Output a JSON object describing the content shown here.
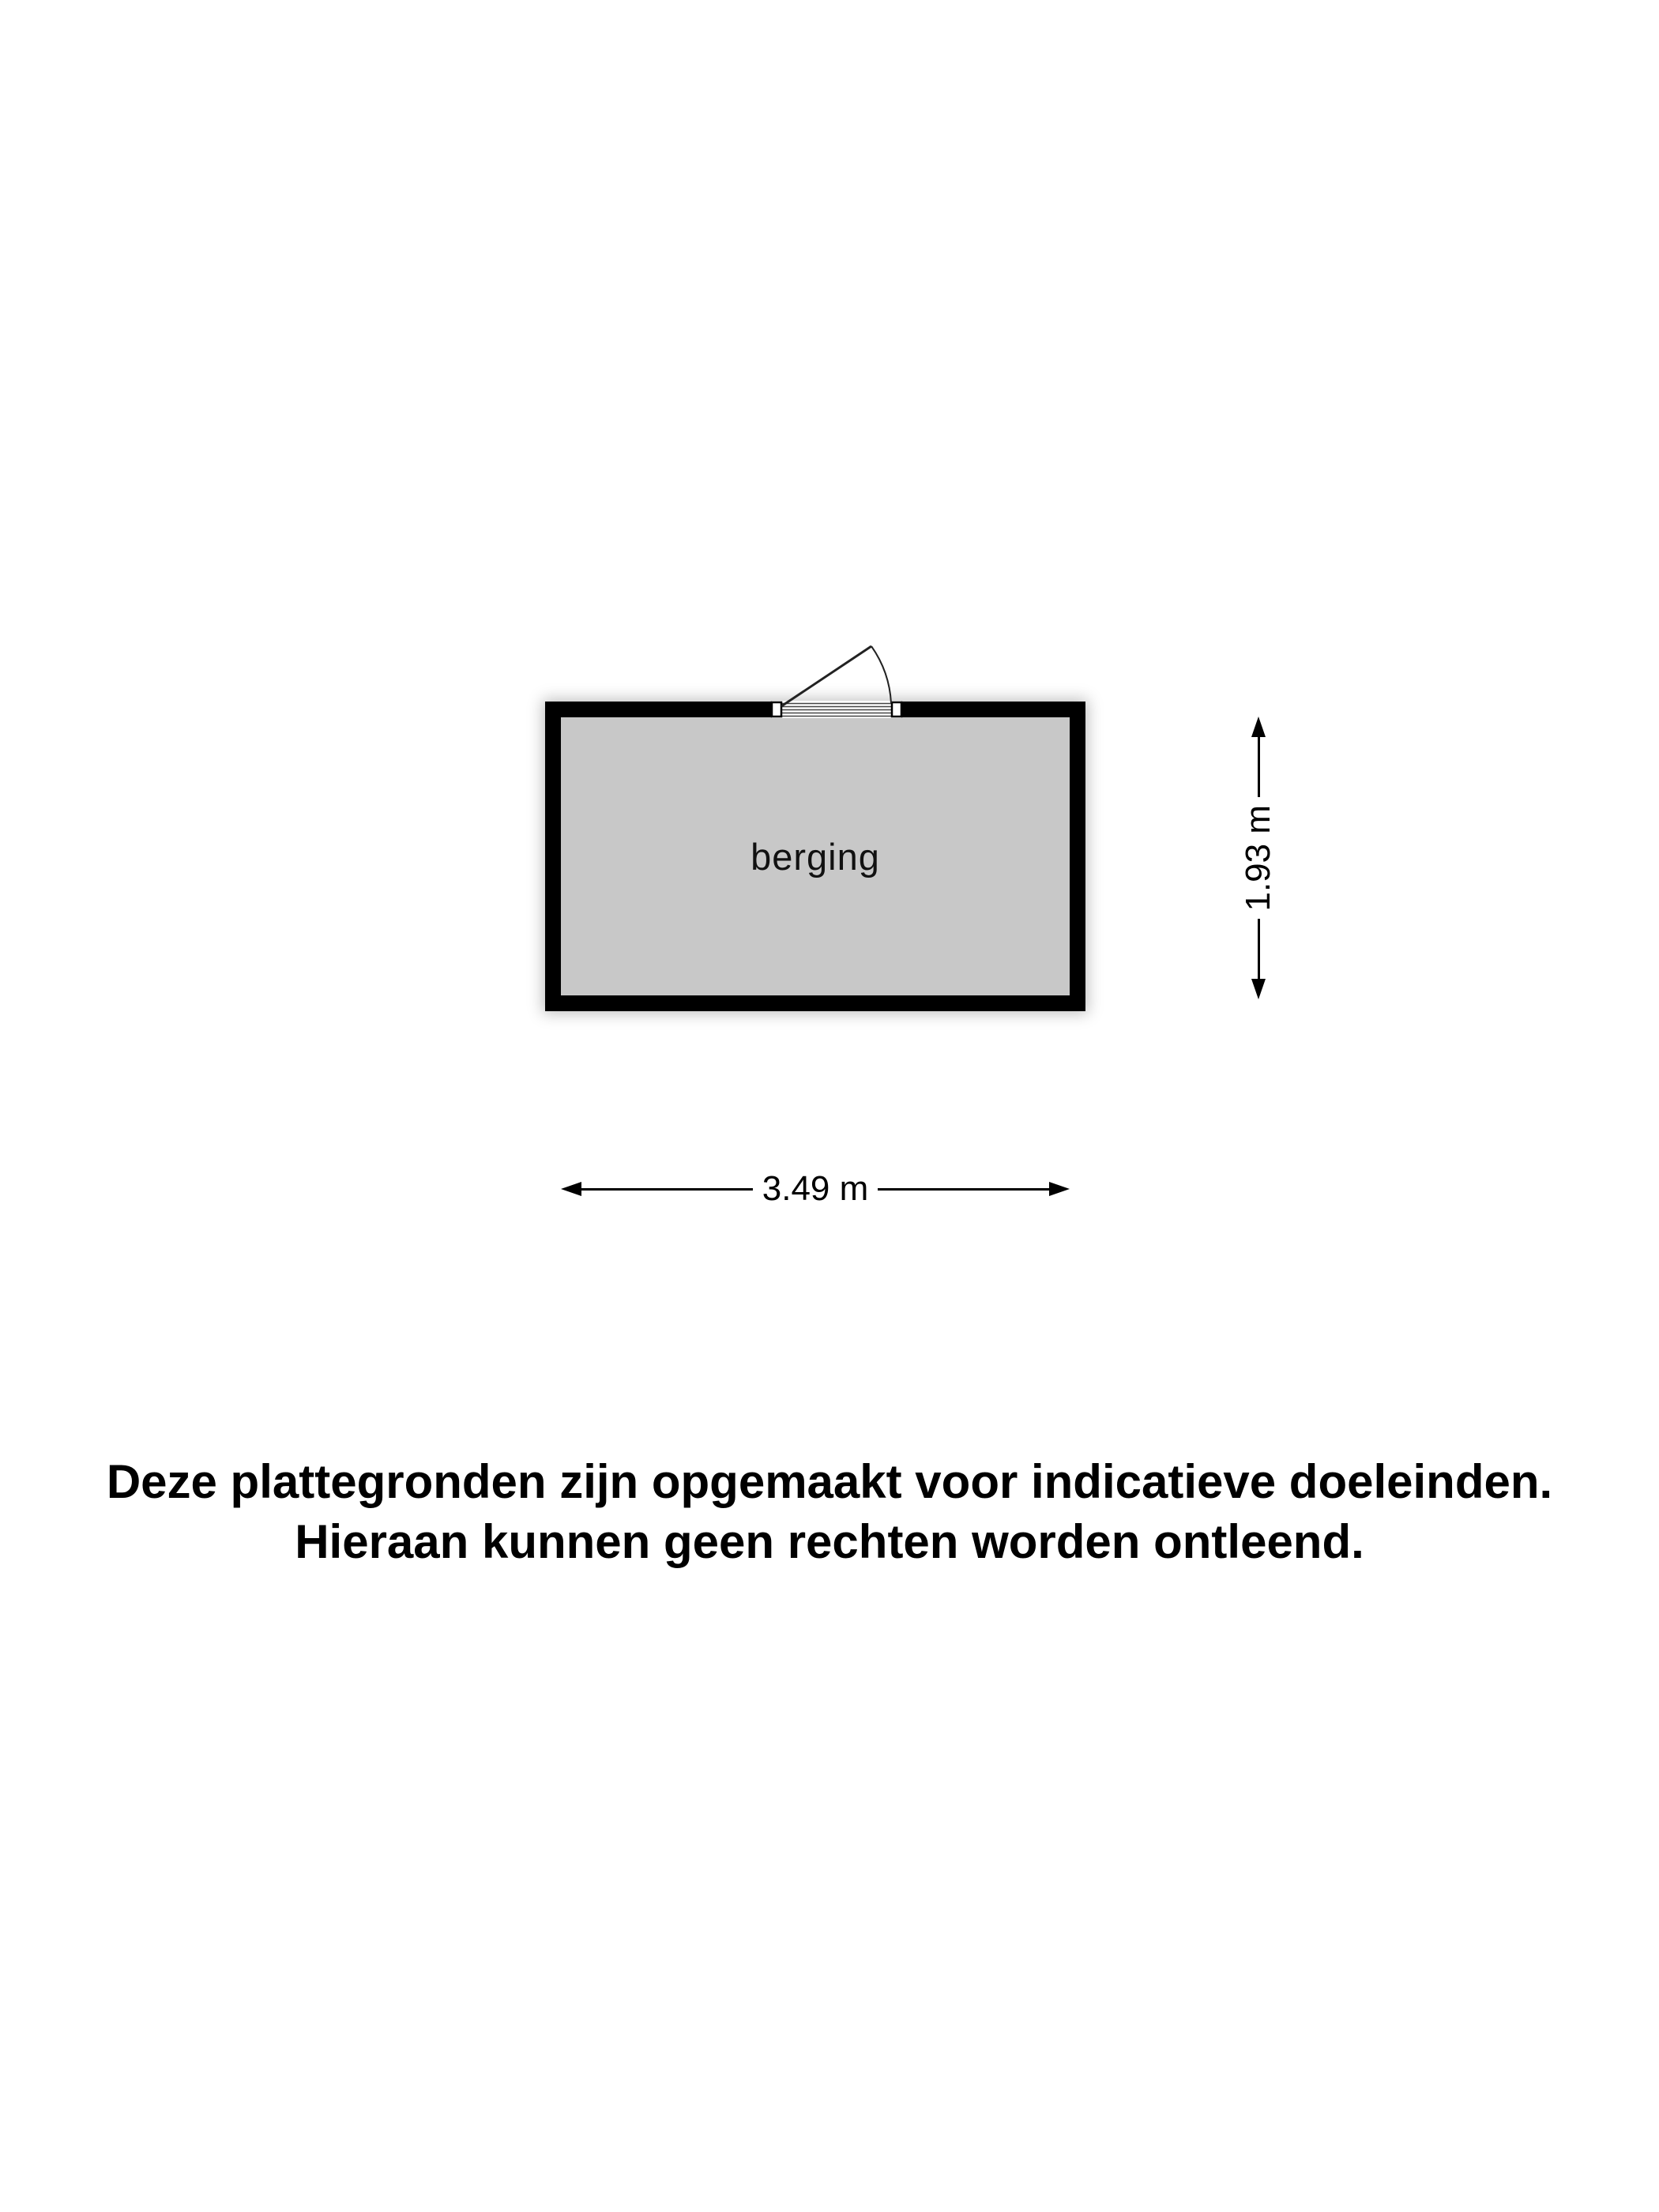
{
  "floorplan": {
    "room": {
      "label": "berging"
    },
    "dimensions": {
      "width_label": "3.49 m",
      "height_label": "1.93 m"
    },
    "colors": {
      "wall": "#000000",
      "floor": "#c8c8c8",
      "background": "#ffffff",
      "line": "#000000"
    }
  },
  "disclaimer": {
    "line1": "Deze plattegronden zijn opgemaakt voor indicatieve doeleinden.",
    "line2": "Hieraan kunnen geen rechten worden ontleend."
  }
}
